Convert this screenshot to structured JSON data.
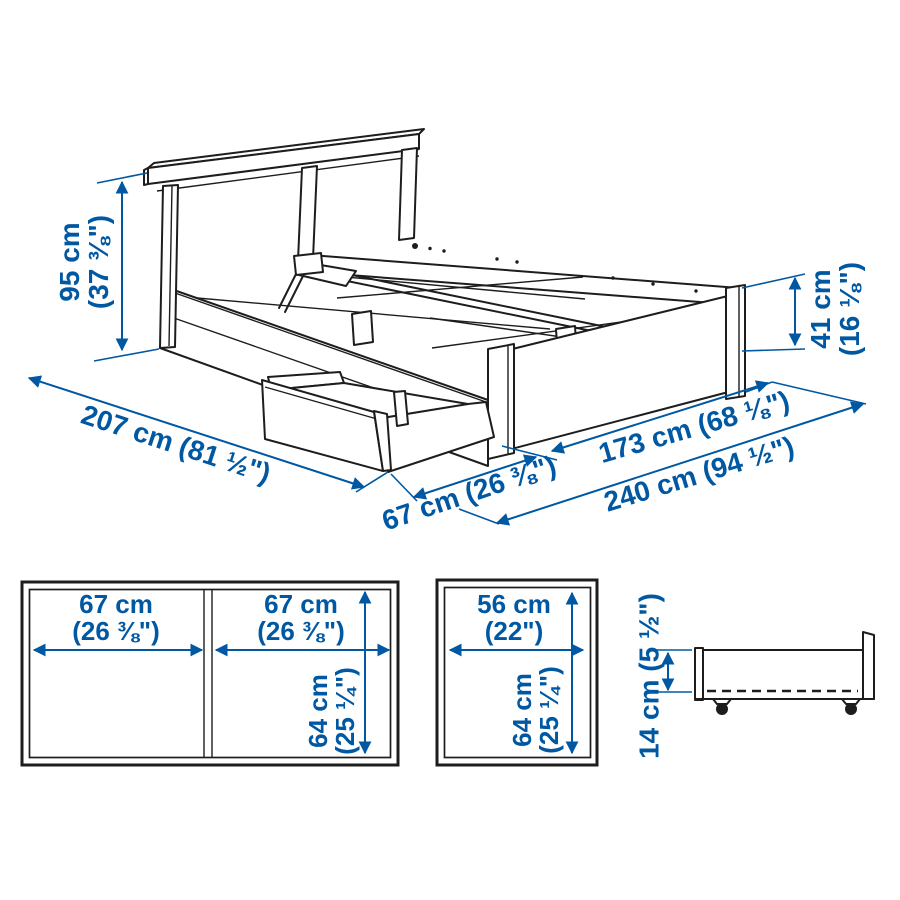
{
  "colors": {
    "dimension_blue": "#0058a3",
    "line_black": "#1d1d1d",
    "background": "#ffffff"
  },
  "main_view": {
    "headboard_height": {
      "metric": "95 cm",
      "imperial": "(37 ⅜\")"
    },
    "side_height": {
      "metric": "41 cm",
      "imperial": "(16 ⅛\")"
    },
    "length": "207 cm (81 ½\")",
    "drawer_pullout": "67 cm (26 ⅜\")",
    "width": "173 cm (68 ⅛\")",
    "total_width_drawer_open": "240 cm (94 ½\")"
  },
  "drawer_pair_top_view": {
    "left_width": {
      "metric": "67 cm",
      "imperial": "(26 ⅜\")"
    },
    "right_width": {
      "metric": "67 cm",
      "imperial": "(26 ⅜\")"
    },
    "depth": {
      "metric": "64 cm",
      "imperial": "(25 ¼\")"
    }
  },
  "single_drawer_top_view": {
    "width": {
      "metric": "56 cm",
      "imperial": "(22\")"
    },
    "depth": {
      "metric": "64 cm",
      "imperial": "(25 ¼\")"
    }
  },
  "drawer_side_view": {
    "height": "14 cm (5 ½\")"
  }
}
